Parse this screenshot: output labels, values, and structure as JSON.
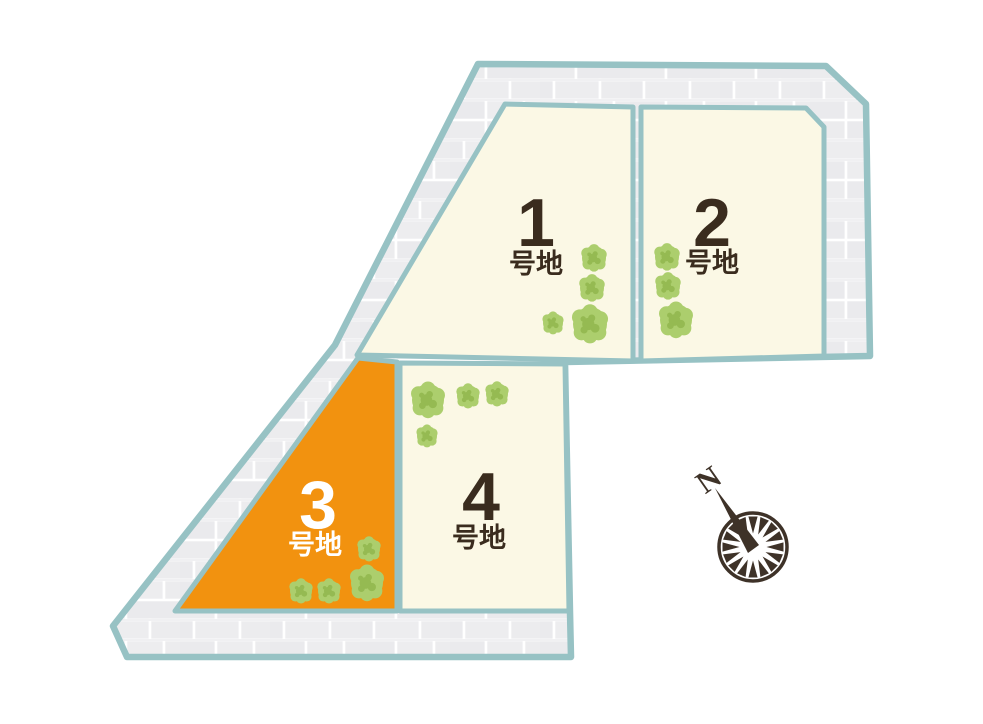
{
  "site_plan": {
    "title": "residential-lot-map",
    "lots": [
      {
        "id": "lot-1",
        "number": "1",
        "suffix": "号地",
        "fill": "#fbf8e5",
        "label_color": "#3a2c1e",
        "highlighted": false
      },
      {
        "id": "lot-2",
        "number": "2",
        "suffix": "号地",
        "fill": "#fbf8e5",
        "label_color": "#3a2c1e",
        "highlighted": false
      },
      {
        "id": "lot-3",
        "number": "3",
        "suffix": "号地",
        "fill": "#f2920f",
        "label_color": "#ffffff",
        "highlighted": true
      },
      {
        "id": "lot-4",
        "number": "4",
        "suffix": "号地",
        "fill": "#fbf8e5",
        "label_color": "#3a2c1e",
        "highlighted": false
      }
    ],
    "compass": {
      "north_label": "N",
      "color": "#3e3228"
    },
    "colors": {
      "boundary_teal": "#97c2c4",
      "road_gray": "#ededef",
      "road_mortar": "#ffffff",
      "lot_cream": "#fbf8e5",
      "lot_orange": "#f2920f",
      "tree_green": "#acce6d",
      "tree_green_dark": "#95ba52",
      "text_dark": "#3a2c1e",
      "background": "#ffffff"
    }
  }
}
